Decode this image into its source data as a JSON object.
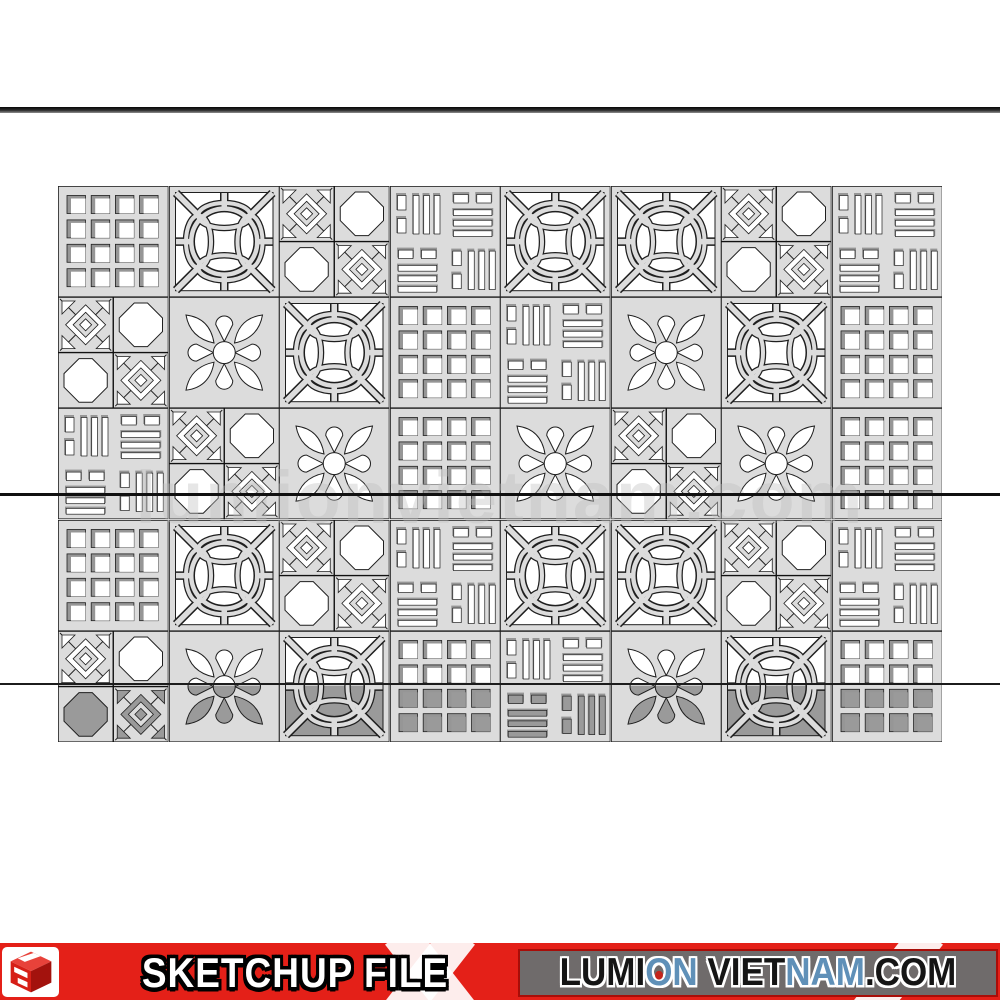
{
  "watermark": {
    "text": "lumionvietnam.com"
  },
  "banner": {
    "sketchup_label": "SKETCHUP FILE",
    "site_segments": [
      {
        "text": "LUMI",
        "color": "#151515"
      },
      {
        "text": "O",
        "color": "#5f90b8",
        "dot": true
      },
      {
        "text": "N",
        "color": "#5f90b8"
      },
      {
        "text": " VIET",
        "color": "#151515"
      },
      {
        "text": "NAM",
        "color": "#5f90b8"
      },
      {
        "text": ".COM",
        "color": "#151515"
      }
    ],
    "colors": {
      "red": "#e42018",
      "gray": "#6f6b6b",
      "border_red": "#a80d08"
    },
    "logo_icon": "sketchup-cube"
  },
  "grid": {
    "rows": 5,
    "cols": 8,
    "pattern_legend": {
      "squares": "4x4 square holes block",
      "circle": "coin ring with arcs block",
      "octaquad": "octagon + diagonal lattice quadrants block",
      "slats": "woven rectangular slats block",
      "flower": "petal flower block"
    },
    "matrix": [
      [
        "squares",
        "circle",
        "octaquad",
        "slats",
        "circle",
        "circle",
        "octaquad",
        "slats"
      ],
      [
        "octaquad",
        "flower",
        "circle",
        "squares",
        "slats",
        "flower",
        "circle",
        "squares"
      ],
      [
        "slats",
        "octaquad",
        "flower",
        "squares",
        "flower",
        "octaquad",
        "flower",
        "squares"
      ],
      [
        "squares",
        "circle",
        "octaquad",
        "slats",
        "circle",
        "circle",
        "octaquad",
        "slats"
      ],
      [
        "octaquad",
        "flower",
        "circle",
        "squares",
        "slats",
        "flower",
        "circle",
        "squares"
      ]
    ],
    "colors": {
      "face": "#dcdcdc",
      "hole": "#ffffff",
      "shadow": "#969696",
      "outline": "#1f1f1f",
      "ground": "#9a9a9a"
    }
  }
}
